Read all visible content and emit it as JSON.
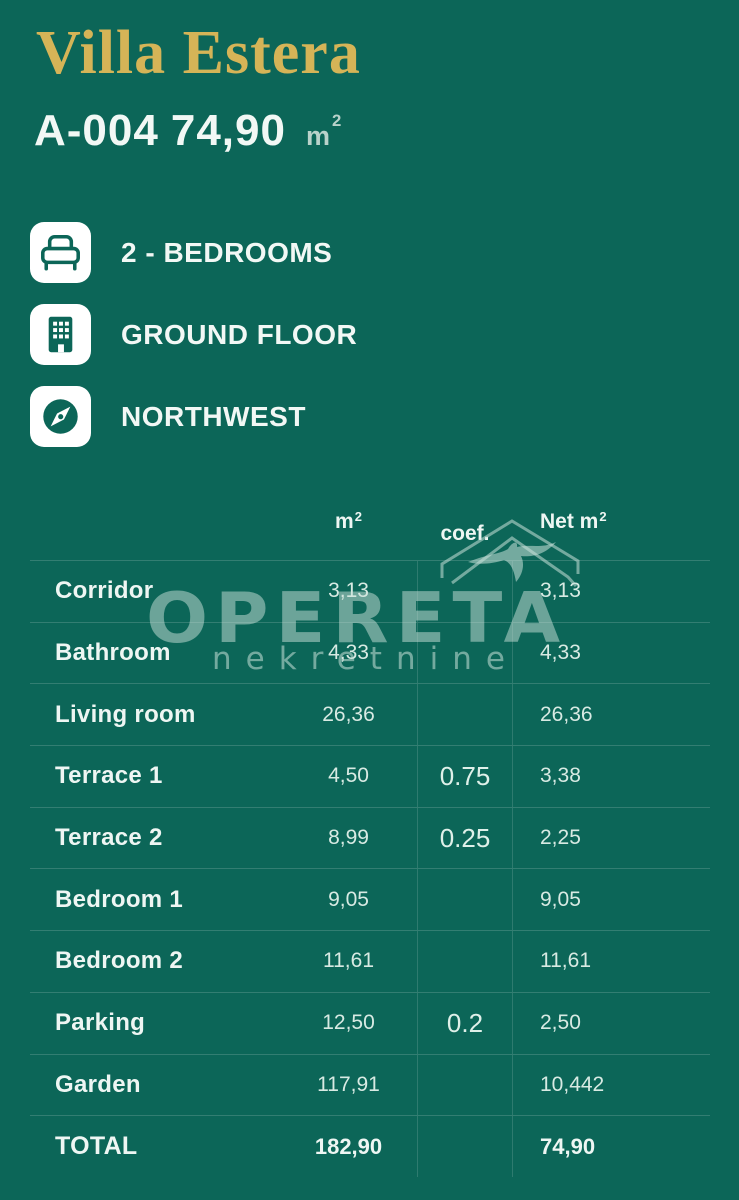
{
  "theme": {
    "background": "#0c6658",
    "gold": "#d5b457",
    "text_white": "#f2f8f5",
    "text_value": "#d8eae3",
    "grid_line": "rgba(255,255,255,0.16)",
    "watermark": "rgba(203,226,218,0.5)"
  },
  "header": {
    "title": "Villa Estera",
    "unit_id": "A-004",
    "area": "74,90",
    "unit": "m",
    "unit_sup": "2"
  },
  "features": [
    {
      "icon": "bed-icon",
      "label": "2 - BEDROOMS"
    },
    {
      "icon": "building-icon",
      "label": "GROUND FLOOR"
    },
    {
      "icon": "compass-icon",
      "label": "NORTHWEST"
    }
  ],
  "table": {
    "headers": {
      "m": "m",
      "m_sup": "2",
      "coef": "coef.",
      "net": "Net m",
      "net_sup": "2"
    },
    "rows": [
      {
        "name": "Corridor",
        "m2": "3,13",
        "coef": "",
        "net": "3,13"
      },
      {
        "name": "Bathroom",
        "m2": "4,33",
        "coef": "",
        "net": "4,33"
      },
      {
        "name": "Living room",
        "m2": "26,36",
        "coef": "",
        "net": "26,36"
      },
      {
        "name": "Terrace 1",
        "m2": "4,50",
        "coef": "0.75",
        "net": "3,38"
      },
      {
        "name": "Terrace 2",
        "m2": "8,99",
        "coef": "0.25",
        "net": "2,25"
      },
      {
        "name": "Bedroom 1",
        "m2": "9,05",
        "coef": "",
        "net": "9,05"
      },
      {
        "name": "Bedroom 2",
        "m2": "11,61",
        "coef": "",
        "net": "11,61"
      },
      {
        "name": "Parking",
        "m2": "12,50",
        "coef": "0.2",
        "net": "2,50"
      },
      {
        "name": "Garden",
        "m2": "117,91",
        "coef": "",
        "net": "10,442"
      },
      {
        "name": "TOTAL",
        "m2": "182,90",
        "coef": "",
        "net": "74,90"
      }
    ]
  },
  "watermark": {
    "brand": "OPERETA",
    "sub": "nekretnine"
  }
}
